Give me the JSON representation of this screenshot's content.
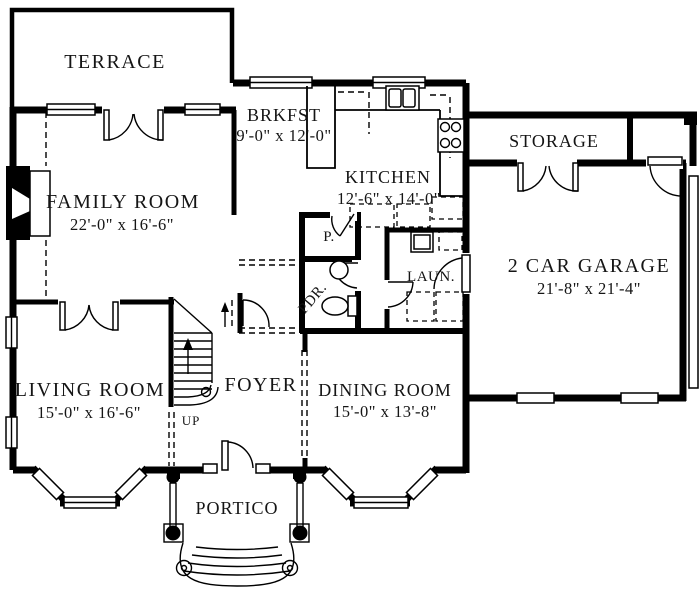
{
  "colors": {
    "wall": "#000000",
    "text": "#151515",
    "background": "#ffffff"
  },
  "rooms": {
    "terrace": {
      "name": "TERRACE"
    },
    "family": {
      "name": "FAMILY ROOM",
      "dims": "22'-0\" x 16'-6\""
    },
    "brkfst": {
      "name": "BRKFST",
      "dims": "9'-0\" x 12'-0\""
    },
    "kitchen": {
      "name": "KITCHEN",
      "dims": "12'-6\" x 14'-0\""
    },
    "storage": {
      "name": "STORAGE"
    },
    "garage": {
      "name": "2 CAR GARAGE",
      "dims": "21'-8\" x 21'-4\""
    },
    "living": {
      "name": "LIVING ROOM",
      "dims": "15'-0\" x 16'-6\""
    },
    "foyer": {
      "name": "FOYER"
    },
    "dining": {
      "name": "DINING ROOM",
      "dims": "15'-0\" x 13'-8\""
    },
    "portico": {
      "name": "PORTICO"
    },
    "pantry": {
      "name": "P."
    },
    "powder": {
      "name": "PDR."
    },
    "laundry": {
      "name": "LAUN."
    }
  },
  "stairs": {
    "direction_label": "UP"
  }
}
